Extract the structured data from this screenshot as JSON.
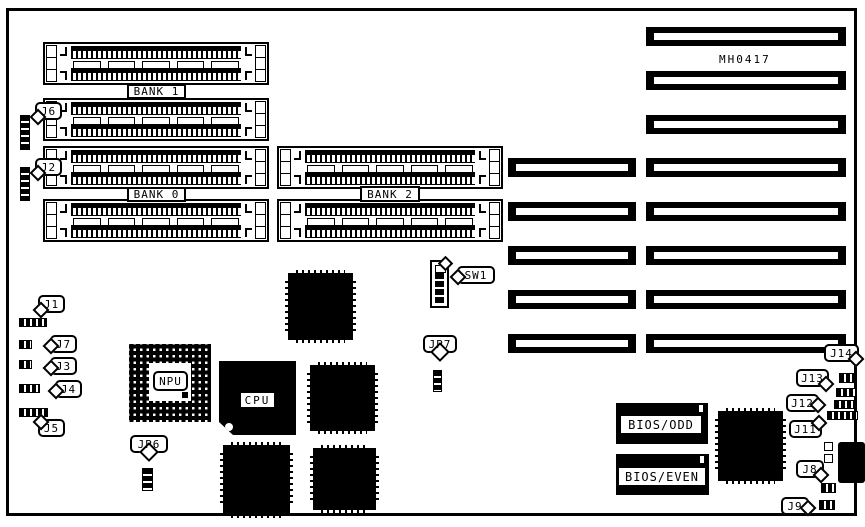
{
  "board": {
    "id_label": "MH0417"
  },
  "memory": {
    "bank_labels": {
      "bank1": "BANK 1",
      "bank0": "BANK 0",
      "bank2": "BANK 2"
    }
  },
  "chips": {
    "npu": "NPU",
    "cpu": "CPU",
    "bios_odd": "BIOS/ODD",
    "bios_even": "BIOS/EVEN"
  },
  "callouts": {
    "j1": "J1",
    "j2": "J2",
    "j3": "J3",
    "j4": "J4",
    "j5": "J5",
    "j6": "J6",
    "j7": "J7",
    "j8": "J8",
    "j9": "J9",
    "j11": "J11",
    "j12": "J12",
    "j13": "J13",
    "j14": "J14",
    "jp6": "JP6",
    "jp7": "JP7",
    "sw1": "SW1"
  }
}
